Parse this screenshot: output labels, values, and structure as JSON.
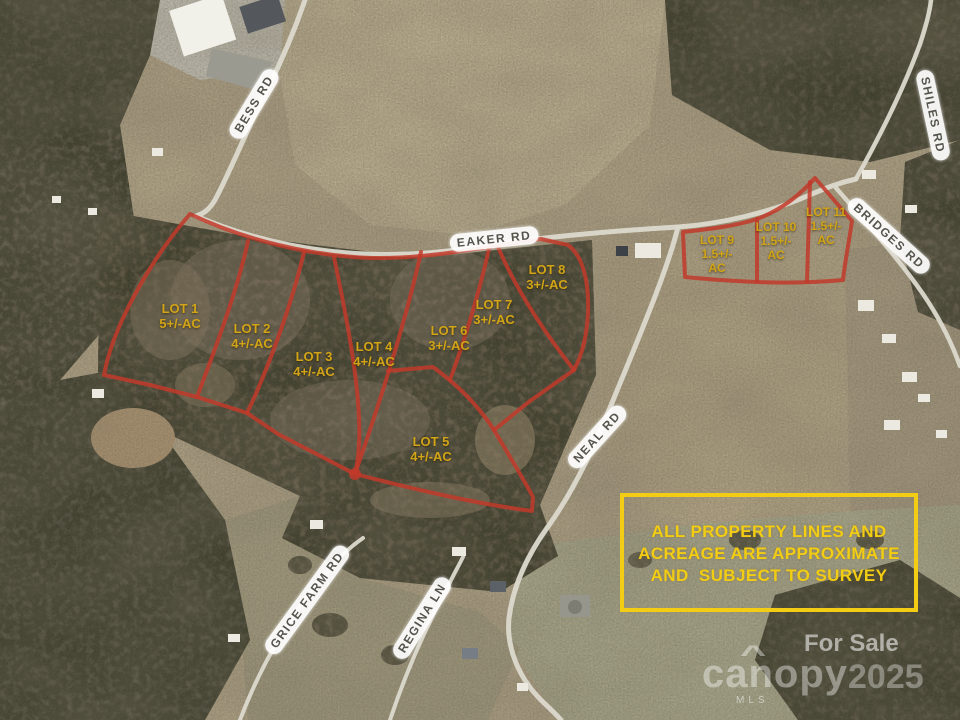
{
  "roads": [
    {
      "id": "bess-rd",
      "label": "BESS RD"
    },
    {
      "id": "eaker-rd",
      "label": "EAKER RD"
    },
    {
      "id": "shiles-rd",
      "label": "SHILES RD"
    },
    {
      "id": "bridges-rd",
      "label": "BRIDGES RD"
    },
    {
      "id": "neal-rd",
      "label": "NEAL RD"
    },
    {
      "id": "grice-farm-rd",
      "label": "GRICE FARM RD"
    },
    {
      "id": "regina-ln",
      "label": "REGINA LN"
    }
  ],
  "lots": [
    {
      "id": "lot-1",
      "lines": [
        "LOT 1",
        "5+/-AC"
      ]
    },
    {
      "id": "lot-2",
      "lines": [
        "LOT 2",
        "4+/-AC"
      ]
    },
    {
      "id": "lot-3",
      "lines": [
        "LOT 3",
        "4+/-AC"
      ]
    },
    {
      "id": "lot-4",
      "lines": [
        "LOT 4",
        "4+/-AC"
      ]
    },
    {
      "id": "lot-5",
      "lines": [
        "LOT 5",
        "4+/-AC"
      ]
    },
    {
      "id": "lot-6",
      "lines": [
        "LOT 6",
        "3+/-AC"
      ]
    },
    {
      "id": "lot-7",
      "lines": [
        "LOT 7",
        "3+/-AC"
      ]
    },
    {
      "id": "lot-8",
      "lines": [
        "LOT 8",
        "3+/-AC"
      ]
    },
    {
      "id": "lot-9",
      "lines": [
        "LOT 9",
        "1.5+/-",
        "AC"
      ]
    },
    {
      "id": "lot-10",
      "lines": [
        "LOT 10",
        "1.5+/-",
        "AC"
      ]
    },
    {
      "id": "lot-11",
      "lines": [
        "LOT 11",
        "1.5+/-",
        "AC"
      ]
    }
  ],
  "disclaimer": {
    "line1": "ALL PROPERTY LINES AND",
    "line2": "ACREAGE ARE APPROXIMATE",
    "line3": "AND  SUBJECT TO SURVEY"
  },
  "watermark": {
    "for_sale": "For Sale",
    "brand": "canopy",
    "roof_glyph": "^",
    "year": "2025",
    "mls": "MLS"
  },
  "colors": {
    "boundary_red": "#c2392a",
    "lot_label_yellow": "#d2a417",
    "disclaimer_yellow": "#f2cd13",
    "road_label_text": "#55554d",
    "road_label_bg": "#ffffff"
  }
}
